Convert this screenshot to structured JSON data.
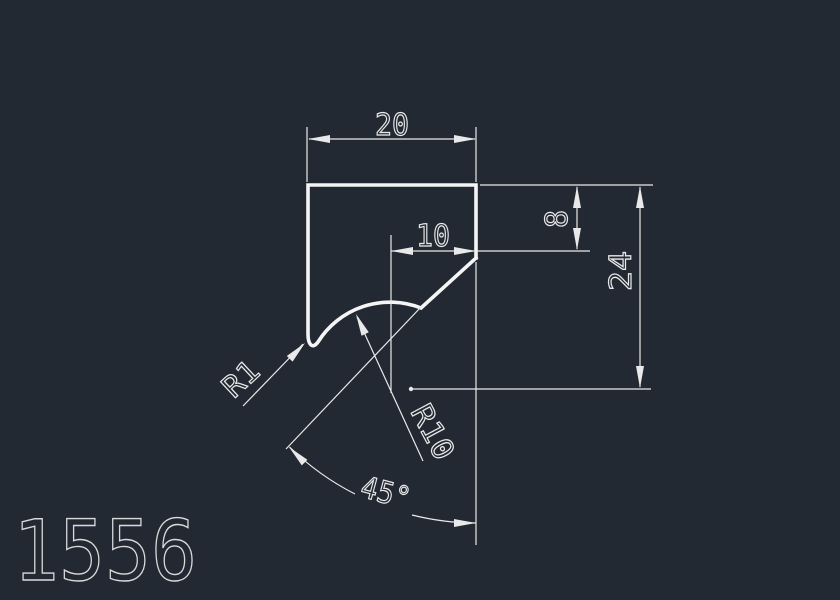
{
  "canvas": {
    "background": "#232933",
    "line_color": "#e9e9e9",
    "profile_color": "#f5f5f5",
    "text_color": "#e9e9e9",
    "part_number_color": "#d9d9d9"
  },
  "drawing": {
    "part_number": "1556",
    "dimensions": {
      "top_width": "20",
      "radius_center_offset": "10",
      "right_depth": "8",
      "overall_height": "24",
      "small_fillet_radius": "R1",
      "large_fillet_radius": "R10",
      "chamfer_angle": "45°"
    }
  }
}
